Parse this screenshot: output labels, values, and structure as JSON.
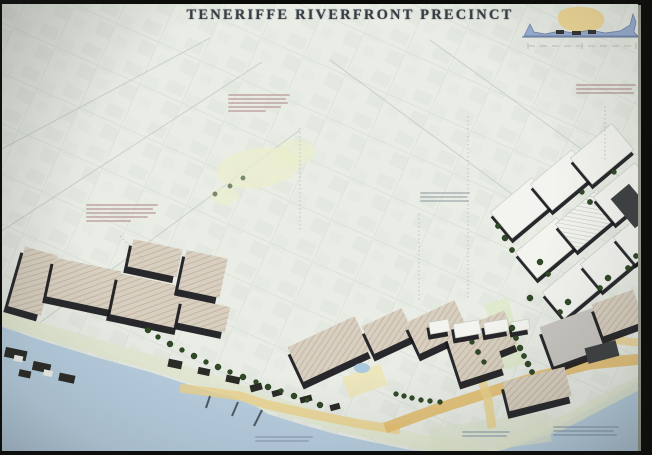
{
  "board": {
    "title": "TENERIFFE RIVERFRONT PRECINCT"
  },
  "inset": {
    "name": "river-section-sketch",
    "scale_bar": "(illegible scale marks)"
  },
  "annotations": [
    {
      "id": "note-park-upper-center",
      "tone": "red",
      "x": 228,
      "y": 94,
      "w": 62,
      "lines": 5,
      "legible": false
    },
    {
      "id": "note-woolstores-left",
      "tone": "red",
      "x": 86,
      "y": 204,
      "w": 72,
      "lines": 5,
      "legible": false
    },
    {
      "id": "note-mid-plan",
      "tone": "gray",
      "x": 420,
      "y": 192,
      "w": 50,
      "lines": 3,
      "legible": false
    },
    {
      "id": "note-upper-right",
      "tone": "red",
      "x": 576,
      "y": 84,
      "w": 60,
      "lines": 3,
      "legible": false
    },
    {
      "id": "note-water-center",
      "tone": "blue",
      "x": 255,
      "y": 436,
      "w": 58,
      "lines": 2,
      "legible": false
    },
    {
      "id": "note-water-mid-right",
      "tone": "blue",
      "x": 462,
      "y": 431,
      "w": 48,
      "lines": 2,
      "legible": false
    },
    {
      "id": "note-water-right",
      "tone": "blue",
      "x": 553,
      "y": 426,
      "w": 66,
      "lines": 3,
      "legible": false
    }
  ],
  "colors": {
    "paper": "#e9ede6",
    "water": "#b7cfe2",
    "shore": "#e3e9d0",
    "road": "#eed288",
    "roadOrange": "#e6bd68",
    "roof": "#d9cfbf",
    "hatch": "#a18f78",
    "shadow": "#17171c",
    "tree": "#2f4b24",
    "grayBld": "#c9c6c1",
    "whiteBld": "#f3f4ef",
    "frame": "#0a0a08",
    "title": "#383e45",
    "park": "#ebeec8",
    "annoRed": "#b07f7f",
    "annoGray": "#8e979e",
    "annoBlue": "#7f93a8",
    "insetHill": "#f0d78e",
    "insetWater": "#8fa8d0"
  }
}
